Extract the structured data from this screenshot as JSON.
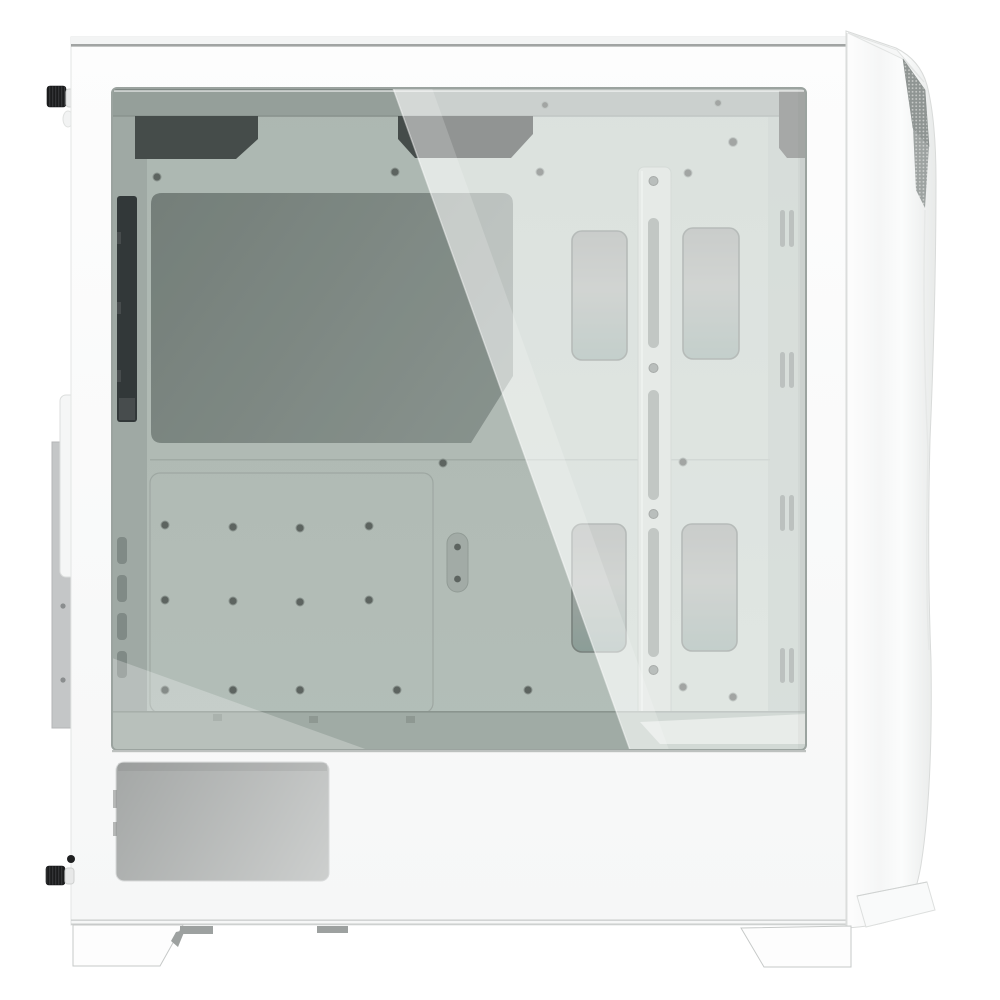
{
  "image": {
    "subject": "White mid-tower PC case, left side view, tempered glass side panel showing empty interior",
    "background_color": "#ffffff"
  },
  "counts": {
    "cable_grommets": 4,
    "cable_tie_slot_pairs_right": 4,
    "rear_vent_slots": 4,
    "cable_bar_slots": 3,
    "feet": 2,
    "thumbscrews": 2,
    "top_cable_cutouts": 2
  },
  "colors": {
    "body_top": "#fdfdfd",
    "body_bottom": "#f6f7f7",
    "body_edge": "#e3e5e4",
    "top_sliver": "#f3f4f4",
    "top_line": "#909493",
    "bottom_line": "#c9cccb",
    "glass_top": "#c4cec8",
    "glass_bottom": "#ccd6d0",
    "glass_frame": "#9ba39f",
    "glass_top_light": "rgba(255,255,255,0.5)",
    "interior_top_band": "#a8b1ad",
    "rear_column": "#b4bdb8",
    "black_strip": "#313538",
    "strip_notch": "#4a4e50",
    "cutout_dark": "#484e4c",
    "cpu_a": "#808a85",
    "cpu_b": "#99a39e",
    "plate_stroke": "#b2bbb6",
    "seam": "#adb6b1",
    "screw": "#646a67",
    "screw_ring": "#9aa39e",
    "oval_fill": "#b7c0bb",
    "oval_stroke": "#a3aca7",
    "grommet_rim": "#868e8a",
    "grom_1": "#a6aba8",
    "grom_2": "#b3b8b4",
    "grom_3": "#9cafa9",
    "bar_fill": "#d5ddd8",
    "bar_stroke": "#b9c3bd",
    "bar_slot": "#99a29d",
    "bar_screw": "#8b938f",
    "bar_screw_stroke": "#6d7370",
    "tie_slot": "#8f9894",
    "front_column": "#b7c1bc",
    "front_column_edge": "#a6b0ab",
    "front_bracket": "#6b6f6d",
    "floor": "#b5c0ba",
    "floor_seam": "#9aa49e",
    "floor_tick": "#9fa9a3",
    "floor_highlight": "#dde2de",
    "reflection_dark": "rgba(62,72,67,0.17)",
    "reflection_bright": "rgba(255,255,255,0.40)",
    "reflection_bright_band": "rgba(255,255,255,0.18)",
    "corner_light": "rgba(255,255,255,0.25)",
    "diag_line": "rgba(255,255,255,0.45)",
    "right_inner_shadow": "rgba(0,0,0,0.05)",
    "front_1": "#fdfdfd",
    "front_2": "#f5f6f6",
    "front_3": "#fbfcfc",
    "front_4": "#e8eae9",
    "front_edge": "#d9dbda",
    "front_flap": "#f6f7f7",
    "front_flap_stroke": "#e2e4e3",
    "mesh": "#8f9593",
    "mesh_dot": "#c9ccca",
    "crease": "#e6e8e7",
    "wedge_fill": "#f9fafa",
    "wedge_stroke": "#dddfde",
    "foot_fill": "#fdfdfd",
    "foot_stroke": "#c6c9c8",
    "tab": "#9da1a0",
    "vent_left": "#a4a7a6",
    "vent_right": "#cdcfce",
    "vent_stroke": "#d8dada",
    "shroud_shadow": "#bdc1bf",
    "shroud_mark": "#8b8e8d",
    "thumb_knob": "#1b1c1d",
    "thumb_stripe": "#3d3f41",
    "thumb_stem": "#4e5153",
    "washer": "#e7e8e8",
    "washer_stroke": "#cfd1d0",
    "rear_plate": "#c4c6c7",
    "rear_plate_stroke": "#b4b6b7",
    "rear_tab": "#f5f6f6",
    "rear_tab_stroke": "#dcdedd",
    "rear_screw": "#8a8d8e"
  }
}
